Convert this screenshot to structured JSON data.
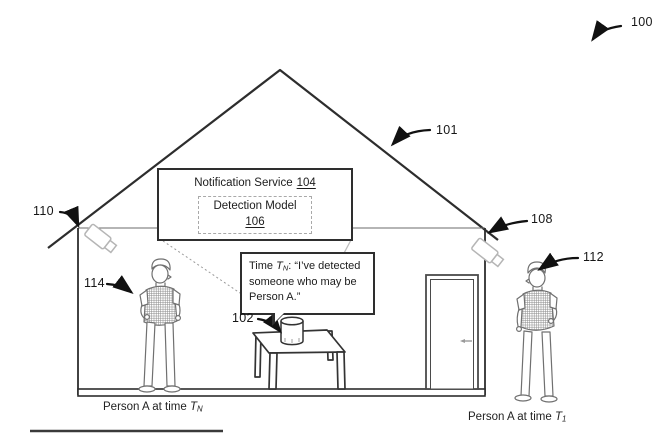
{
  "figure": {
    "refs": {
      "overall": "100",
      "roof": "101",
      "assistant_device": "102",
      "camera_right": "108",
      "camera_left": "110",
      "person_outside": "112",
      "person_inside": "114"
    },
    "notification_box": {
      "title": "Notification Service",
      "title_ref": "104",
      "model_title": "Detection Model",
      "model_ref": "106"
    },
    "speech_bubble": {
      "prefix": "Time ",
      "time_var": "T",
      "time_sub": "N",
      "message": ": “I’ve detected someone who may be Person A.”"
    },
    "captions": {
      "left_text": "Person A at time ",
      "left_time_var": "T",
      "left_time_sub": "N",
      "right_text": "Person A at time ",
      "right_time_var": "T",
      "right_time_sub": "1"
    },
    "icons": {
      "camera_left": "security-camera-icon",
      "camera_right": "security-camera-icon",
      "device": "smart-speaker-icon"
    },
    "colors": {
      "line": "#2d2d2d",
      "arrow": "#111111",
      "light_line": "#b5b5b5",
      "sketch": "#707070"
    }
  }
}
